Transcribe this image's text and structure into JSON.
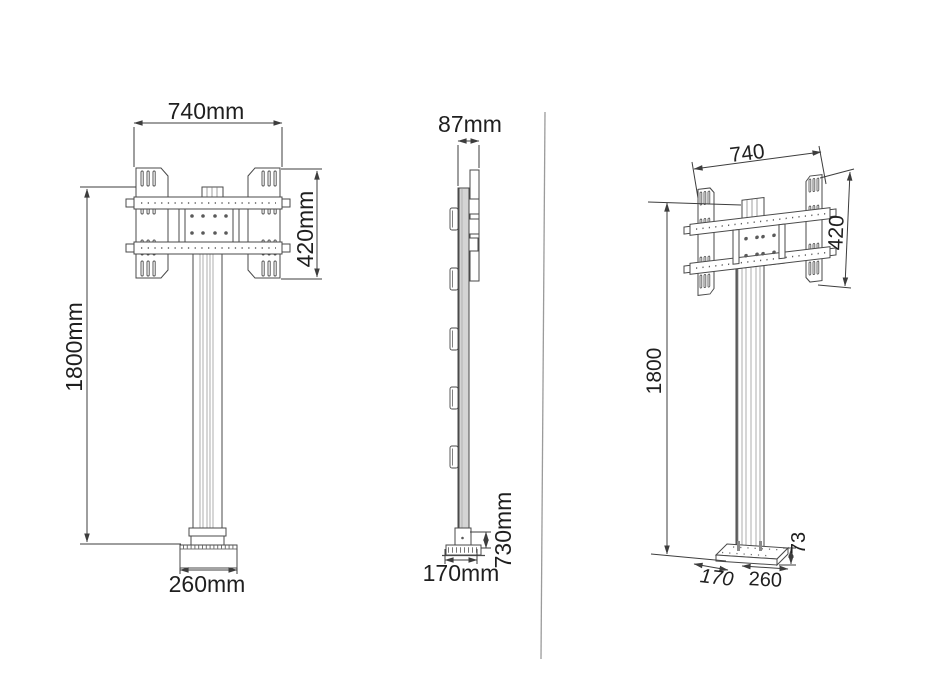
{
  "drawing": {
    "title": "TV floor stand technical drawing, three views",
    "front_view": {
      "width_label": "740mm",
      "bracket_height_label": "420mm",
      "height_label": "1800mm",
      "base_width_label": "260mm"
    },
    "side_view": {
      "depth_label": "87mm",
      "base_height_label": "730mm",
      "base_depth_label": "170mm"
    },
    "perspective_view": {
      "width_label": "740",
      "bracket_height_label": "420",
      "height_label": "1800",
      "base_height_label": "73",
      "base_depth_label": "170",
      "base_width_label": "260"
    },
    "colors": {
      "part_line": "#4a4a4a",
      "dimension_line": "#3d3d3d",
      "text": "#1f1f1f",
      "column_fill": "#d4d4d4",
      "divider_line": "#9b9b9b",
      "background": "#ffffff"
    }
  }
}
